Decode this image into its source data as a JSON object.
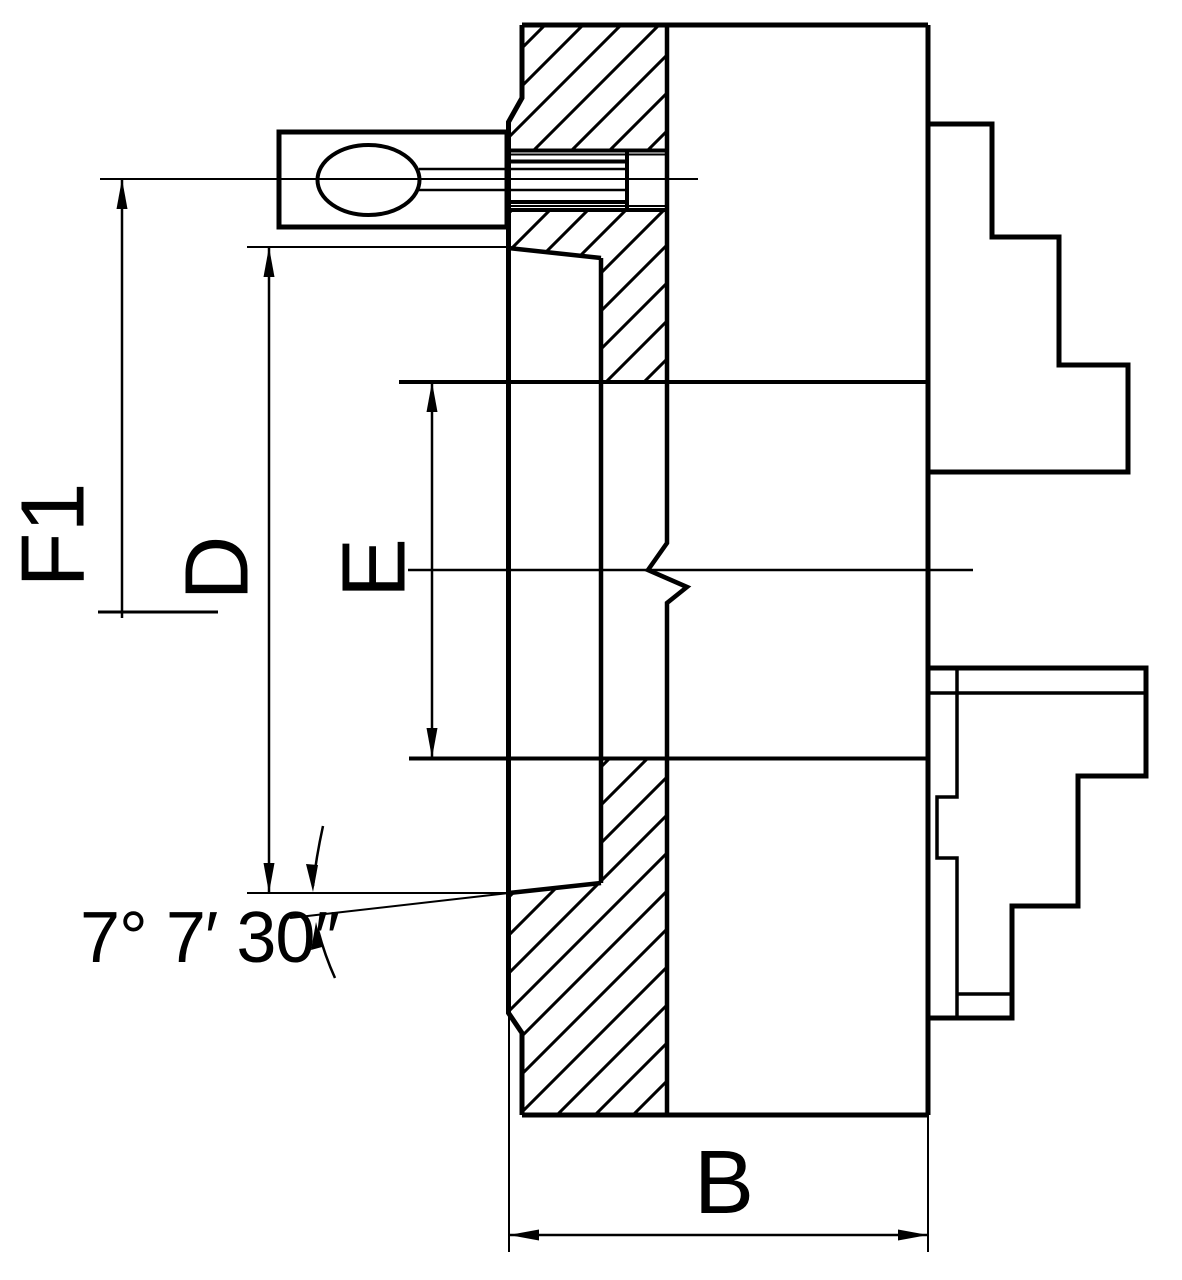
{
  "diagram": {
    "type": "technical-drawing",
    "subject": "lathe chuck cross-section with mounting taper and jaws",
    "background_color": "#ffffff",
    "line_color": "#000000",
    "labels": {
      "f1": "F1",
      "d": "D",
      "e": "E",
      "b": "B",
      "angle": "7° 7′ 30″"
    }
  }
}
